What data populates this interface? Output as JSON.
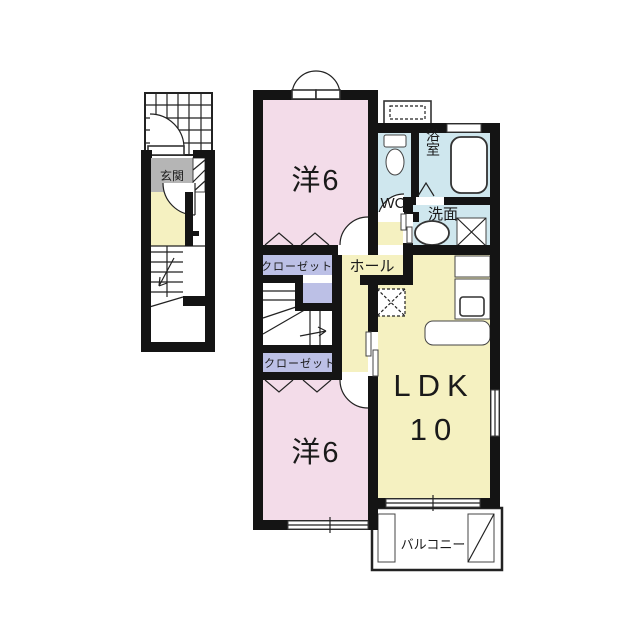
{
  "floorplan": {
    "colors": {
      "wall": "#141414",
      "room_pink": "#f3dce9",
      "room_yellow": "#f5f1c1",
      "room_blue": "#cfe7ee",
      "closet_purple": "#bcc0e6",
      "genkan_gray": "#b5b5b5",
      "bg": "#ffffff"
    },
    "labels": {
      "genkan": "玄関",
      "bedroom_upper": "洋6",
      "bedroom_lower": "洋6",
      "closet_upper": "クローゼット",
      "closet_lower": "クローゼット",
      "hall": "ホール",
      "wc": "WC",
      "bath": "浴室",
      "washroom": "洗面",
      "ldk_name": "LDK",
      "ldk_size": "10",
      "balcony": "バルコニー"
    }
  }
}
